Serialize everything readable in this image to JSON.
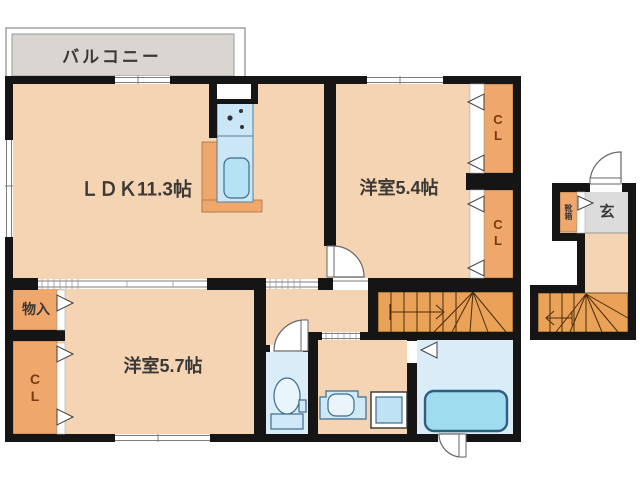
{
  "title": "apartment-floor-plan",
  "palette": {
    "wall": "#151515",
    "floor": "#f5d4b4",
    "closet": "#f0a76b",
    "stairs": "#e9a258",
    "balcony": "#d9d5d0",
    "entrance_tile": "#dcdcdc",
    "water_floor": "#d9ecf8",
    "counter_blue": "#cbe7f7",
    "tub_blue": "#9fdcf0",
    "label_text": "#3b3835",
    "closet_text": "#7b3a10"
  },
  "labels": {
    "balcony": "バルコニー",
    "ldk": "ＬＤＫ11.3帖",
    "bedroom_a": "洋室5.4帖",
    "bedroom_b": "洋室5.7帖",
    "closet_a": "CL",
    "closet_b": "CL",
    "closet_c": "CL",
    "storage": "物入",
    "entrance": "玄",
    "shoe_cabinet": "靴箱"
  }
}
